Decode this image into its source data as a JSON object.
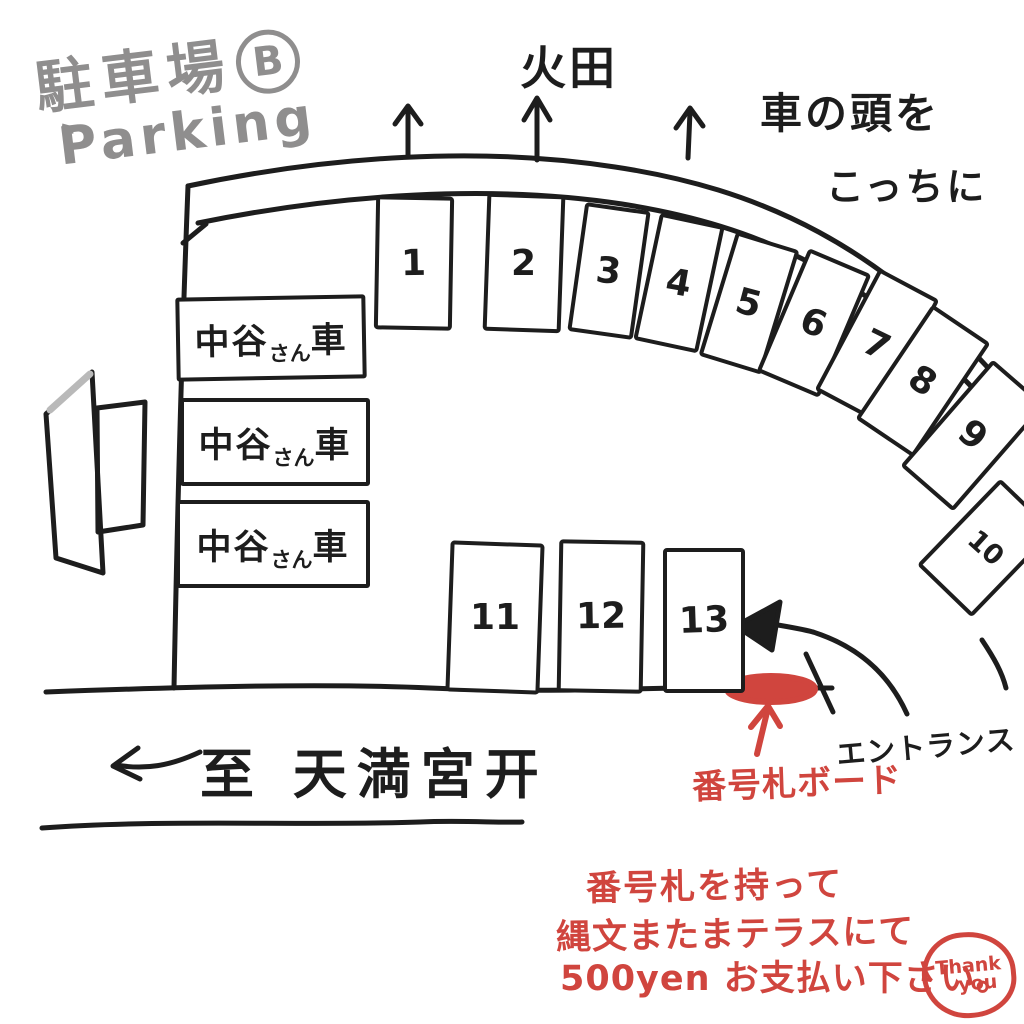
{
  "colors": {
    "ink": "#1d1d1d",
    "red": "#d0453e",
    "gray": "#8f8e8e"
  },
  "title": {
    "jp": "駐車場",
    "badge": "B",
    "en": "Parking",
    "quote": "〝"
  },
  "surroundings": {
    "field_label": "火田",
    "car_head_note_line1": "車の頭を",
    "car_head_note_line2": "こっちに"
  },
  "spaces": {
    "arc": [
      "1",
      "2",
      "3",
      "4",
      "5",
      "6",
      "7",
      "8",
      "9",
      "10"
    ],
    "row": [
      "11",
      "12",
      "13"
    ]
  },
  "reserved": {
    "boxes": [
      {
        "pre": "中谷",
        "suffix": "さん",
        "post": "車"
      },
      {
        "pre": "中谷",
        "suffix": "さん",
        "post": "車"
      },
      {
        "pre": "中谷",
        "suffix": "さん",
        "post": "車"
      }
    ]
  },
  "road": {
    "destination": "至 天満宮开"
  },
  "entrance": {
    "label": "エントランス"
  },
  "board": {
    "label": "番号札ボード"
  },
  "notice": {
    "line1": "番号札を持って",
    "line2": "縄文またまテラスにて",
    "line3": "500yen お支払い下さい。",
    "thanks_line1": "Thank",
    "thanks_line2": "you"
  }
}
